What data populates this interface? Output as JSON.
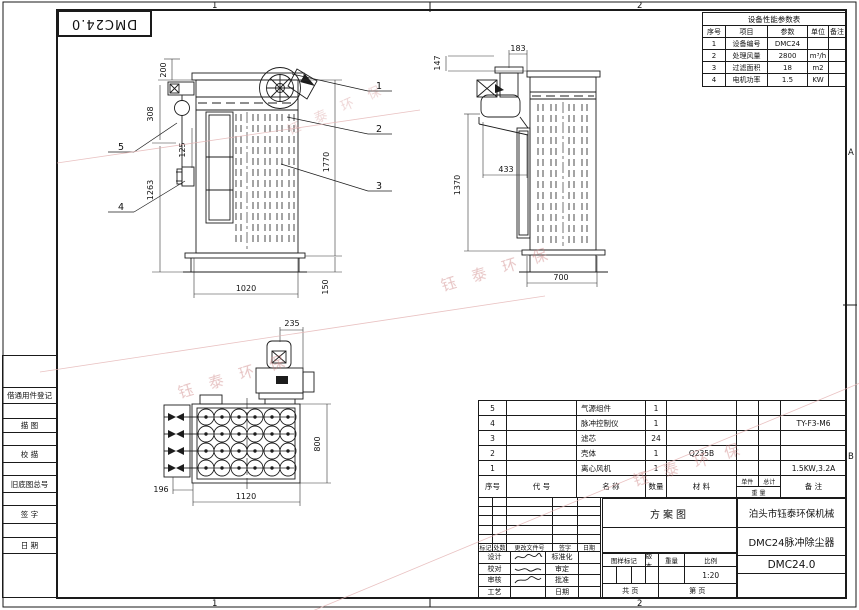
{
  "zones": {
    "top1": "1",
    "top2": "2",
    "bottom1": "1",
    "bottom2": "2",
    "rightA": "A",
    "rightB": "B"
  },
  "ref_box": {
    "label": "DMC24.0"
  },
  "margin_labels": [
    "借通用件登记",
    "描 图",
    "校 描",
    "旧底图总号",
    "签 字",
    "日 期"
  ],
  "param_table": {
    "title": "设备性能参数表",
    "headers": [
      "序号",
      "项目",
      "参数",
      "单位",
      "备注"
    ],
    "rows": [
      [
        "1",
        "设备编号",
        "DMC24",
        "",
        ""
      ],
      [
        "2",
        "处理风量",
        "2800",
        "m³/h",
        ""
      ],
      [
        "3",
        "过滤面积",
        "18",
        "m2",
        ""
      ],
      [
        "4",
        "电机功率",
        "1.5",
        "KW",
        ""
      ]
    ]
  },
  "bom": {
    "headers": {
      "no": "序号",
      "code": "代  号",
      "name": "名  称",
      "qty": "数量",
      "material": "材  料",
      "unit": "单件",
      "total": "总计",
      "weight": "重  量",
      "remark": "备  注"
    },
    "rows": [
      {
        "no": "5",
        "code": "",
        "name": "气源组件",
        "qty": "1",
        "material": "",
        "unit": "",
        "total": "",
        "remark": ""
      },
      {
        "no": "4",
        "code": "",
        "name": "脉冲控制仪",
        "qty": "1",
        "material": "",
        "unit": "",
        "total": "",
        "remark": "TY-F3-M6"
      },
      {
        "no": "3",
        "code": "",
        "name": "滤芯",
        "qty": "24",
        "material": "",
        "unit": "",
        "total": "",
        "remark": ""
      },
      {
        "no": "2",
        "code": "",
        "name": "壳体",
        "qty": "1",
        "material": "Q235B",
        "unit": "",
        "total": "",
        "remark": ""
      },
      {
        "no": "1",
        "code": "",
        "name": "离心风机",
        "qty": "1",
        "material": "",
        "unit": "",
        "total": "",
        "remark": "1.5KW,3.2A"
      }
    ]
  },
  "title_block": {
    "revision_headers": [
      "标记",
      "处数",
      "更改文件号",
      "签字",
      "日期"
    ],
    "sign_rows": [
      {
        "left": "设计",
        "right": "标准化"
      },
      {
        "left": "校对",
        "right": "审定"
      },
      {
        "left": "审核",
        "right": "批准"
      },
      {
        "left": "工艺",
        "right": "日期"
      }
    ],
    "drawing_type": "方案图",
    "stamp_headers": [
      "图样标记",
      "版本",
      "重量",
      "比例"
    ],
    "scale": "1:20",
    "pages_total": "共  页",
    "pages_no": "第  页",
    "company": "泊头市钰泰环保机械",
    "product": "DMC24脉冲除尘器",
    "drawing_no": "DMC24.0"
  },
  "views": {
    "front": {
      "dims": [
        "200",
        "308",
        "125",
        "1263",
        "1770",
        "1020",
        "150"
      ],
      "balloons": [
        "1",
        "2",
        "3",
        "4",
        "5"
      ]
    },
    "side": {
      "dims": [
        "147",
        "183",
        "433",
        "1370",
        "700"
      ]
    },
    "top": {
      "dims": [
        "235",
        "800",
        "196",
        "1120"
      ]
    }
  },
  "watermark": {
    "text": "钰 泰 环 保",
    "color": "#c97b7b"
  }
}
